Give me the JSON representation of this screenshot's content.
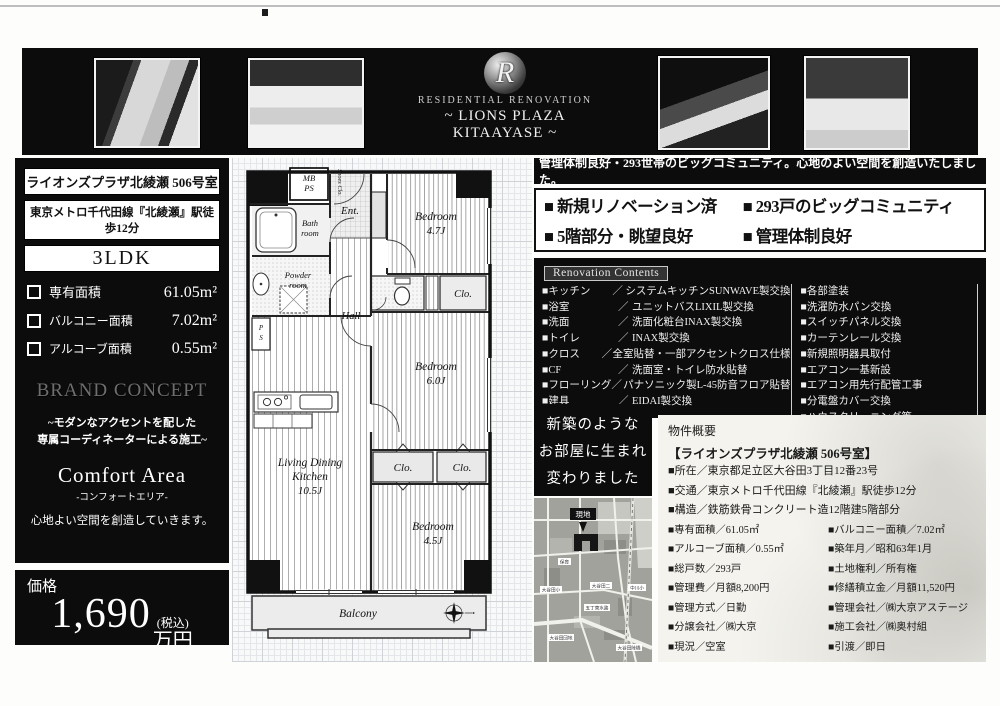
{
  "header": {
    "logo_monogram": "R",
    "logo_line1": "RESIDENTIAL RENOVATION",
    "logo_line2": "~ LIONS PLAZA KITAAYASE ~"
  },
  "property_card": {
    "name": "ライオンズプラザ北綾瀬  506号室",
    "access": "東京メトロ千代田線『北綾瀬』駅徒歩12分",
    "layout": "3LDK",
    "areas": [
      {
        "label": "専有面積",
        "value": "61.05m²"
      },
      {
        "label": "バルコニー面積",
        "value": "7.02m²"
      },
      {
        "label": "アルコーブ面積",
        "value": "0.55m²"
      }
    ]
  },
  "brand_concept": {
    "title": "BRAND CONCEPT",
    "subtitle1": "~モダンなアクセントを配した",
    "subtitle2": "専属コーディネーターによる施工~",
    "name_en": "Comfort Area",
    "name_jp": "-コンフォートエリア-",
    "tagline": "心地よい空間を創造していきます。"
  },
  "price": {
    "label": "価格",
    "amount": "1,690",
    "tax_note": "(税込)",
    "unit": "万円"
  },
  "headline_bar": "管理体制良好・293世帯のビッグコミュニティ。心地のよい空間を創造いたしました。",
  "features": [
    "■ 新規リノベーション済",
    "■ 293戸のビッグコミュニティ",
    "■ 5階部分・眺望良好",
    "■ 管理体制良好"
  ],
  "renovation": {
    "title": "Renovation Contents",
    "sep": "／",
    "left": [
      {
        "label": "■キッチン",
        "desc": "システムキッチンSUNWAVE製交換"
      },
      {
        "label": "■浴室",
        "desc": "ユニットバスLIXIL製交換"
      },
      {
        "label": "■洗面",
        "desc": "洗面化粧台INAX製交換"
      },
      {
        "label": "■トイレ",
        "desc": "INAX製交換"
      },
      {
        "label": "■クロス",
        "desc": "全室貼替・一部アクセントクロス仕様"
      },
      {
        "label": "■CF",
        "desc": "洗面室・トイレ防水貼替"
      },
      {
        "label": "■フローリング",
        "desc": "パナソニック製L-45防音フロア貼替"
      },
      {
        "label": "■建具",
        "desc": "EIDAI製交換"
      }
    ],
    "right": [
      "■各部塗装",
      "■洗濯防水パン交換",
      "■スイッチパネル交換",
      "■カーテンレール交換",
      "■新規照明器具取付",
      "■エアコン一基新設",
      "■エアコン用先行配管工事",
      "■分電盤カバー交換",
      "■ハウスクリーニング等"
    ]
  },
  "catch_box": {
    "line1": "新築のような",
    "line2": "お部屋に生まれ",
    "line3": "変わりました"
  },
  "map": {
    "site_label": "現地",
    "labels": [
      "保育",
      "大谷田小",
      "大谷田二",
      "中川小",
      "五丁東水路",
      "大谷田団地",
      "大谷田陸橋"
    ]
  },
  "overview": {
    "title": "物件概要",
    "subtitle": "【ライオンズプラザ北綾瀬  506号室】",
    "full_rows": [
      "■所在／東京都足立区大谷田3丁目12番23号",
      "■交通／東京メトロ千代田線『北綾瀬』駅徒歩12分",
      "■構造／鉄筋鉄骨コンクリート造12階建5階部分"
    ],
    "pair_rows": [
      [
        "■専有面積／61.05㎡",
        "■バルコニー面積／7.02㎡"
      ],
      [
        "■アルコーブ面積／0.55㎡",
        "■築年月／昭和63年1月"
      ],
      [
        "■総戸数／293戸",
        "■土地権利／所有権"
      ],
      [
        "■管理費／月額8,200円",
        "■修繕積立金／月額11,520円"
      ],
      [
        "■管理方式／日勤",
        "■管理会社／㈱大京アステージ"
      ],
      [
        "■分譲会社／㈱大京",
        "■施工会社／㈱奥村組"
      ],
      [
        "■現況／空室",
        "■引渡／即日"
      ]
    ]
  },
  "floorplan": {
    "mb": "MB",
    "ps": "PS",
    "ent": "Ent.",
    "shoes_clo": "Shoes Clo.",
    "bath1": "Bath",
    "bath2": "room",
    "powder1": "Powder",
    "powder2": "room",
    "ps2a": "P",
    "ps2b": "S",
    "hall": "Hall",
    "clo_top": "Clo.",
    "bedroom_a_name": "Bedroom",
    "bedroom_a_size": "4.7J",
    "bedroom_b_name": "Bedroom",
    "bedroom_b_size": "6.0J",
    "bedroom_c_name": "Bedroom",
    "bedroom_c_size": "4.5J",
    "ldk1": "Living Dining",
    "ldk2": "Kitchen",
    "ldk3": "10.5J",
    "clo_b1": "Clo.",
    "clo_b2": "Clo.",
    "balcony": "Balcony"
  }
}
